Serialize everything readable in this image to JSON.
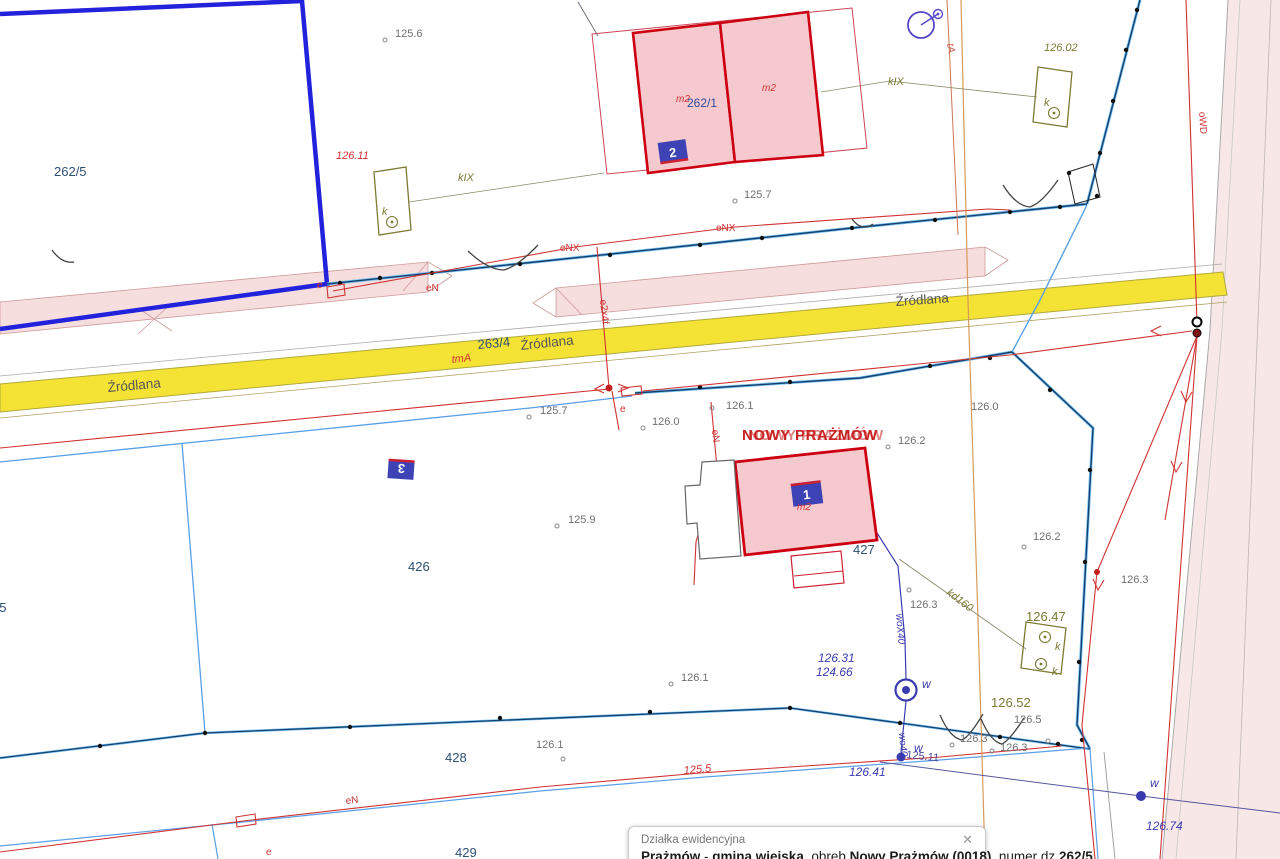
{
  "labels": {
    "road_name": "Źródlana",
    "place": "NOWY PRAŻMÓW",
    "parcel_262_5": "262/5",
    "parcel_262_1": "262/1",
    "parcel_263_4": "263/4",
    "parcel_25": "25",
    "parcel_426": "426",
    "parcel_427": "427",
    "parcel_428": "428",
    "parcel_429": "429",
    "badge_1": "1",
    "badge_2": "2",
    "badge_3": "3",
    "m2": "m2",
    "elev": {
      "e125_6": "125.6",
      "e125_7": "125.7",
      "e125_9": "125.9",
      "e126_0": "126.0",
      "e126_1": "126.1",
      "e126_2": "126.2",
      "e126_3": "126.3",
      "e126_5": "126.5",
      "e126_02": "126.02",
      "e126_11": "126.11",
      "e126_31": "126.31",
      "e124_66": "124.66",
      "e126_41": "126.41",
      "e126_47": "126.47",
      "e126_52": "126.52",
      "e126_74": "126.74"
    },
    "meas": {
      "m125_5": "125.5",
      "m125_11": "125.11"
    },
    "util": {
      "eNX": "eNX",
      "eN": "eN",
      "e": "e",
      "tmA": "tmA",
      "tA": "tA",
      "oWD": "oWD",
      "kIX": "kIX",
      "kd160": "kd160",
      "e2x4f": "e2x4f",
      "woX40": "woX40",
      "wo40": "wo40",
      "w": "w",
      "k": "k"
    }
  },
  "popup": {
    "title": "Działka ewidencyjna",
    "close": "✕",
    "p1": "Prażmów",
    "sep": " - ",
    "p2": "gmina wiejska",
    "t1": ", obręb ",
    "p3": "Nowy Prażmów (0018)",
    "t2": ", numer dz ",
    "p4": "262/5"
  },
  "colors": {
    "road_fill": "#f4e335",
    "parcel_blue": "#2222dd",
    "building_red": "#cc0011",
    "building_fill": "#f6c9ce",
    "boundary_blue": "#2b7bd4",
    "utility_red": "#d03333",
    "olive": "#7a7a33",
    "water_blue": "#3b3bb0",
    "badge_blue": "#3d43b4",
    "verge_pink": "#f6dede",
    "orange": "#d89a5a"
  }
}
